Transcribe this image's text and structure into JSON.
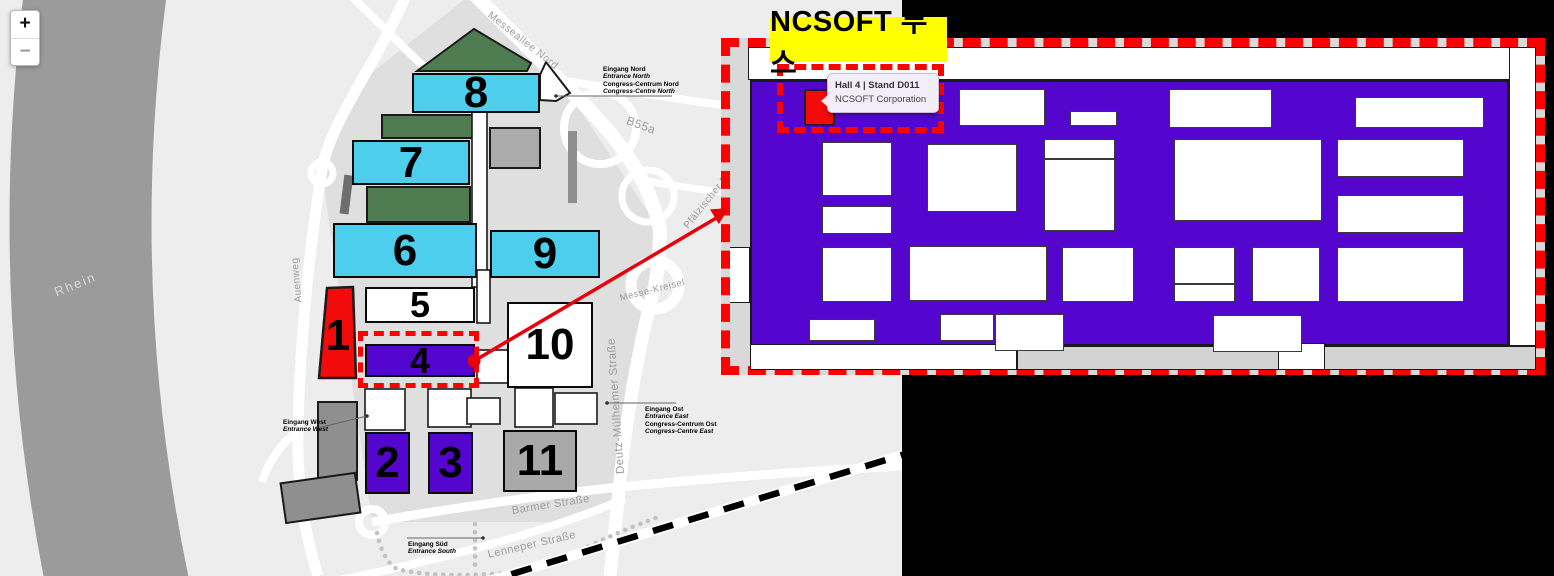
{
  "page": {
    "background": "#000000"
  },
  "colors": {
    "cyan": "#4CCEEC",
    "purple": "#5406CE",
    "red": "#F10B0B",
    "white": "#FFFFFF",
    "gray": "#A9A9A9",
    "green": "#4E7B50",
    "river": "#9B9B9B",
    "accent_red": "#FF0000",
    "callout_yellow": "#FFFF00"
  },
  "zoom_control": {
    "zoom_in_label": "+",
    "zoom_out_label": "−"
  },
  "map": {
    "river_label": "Rhein",
    "halls": [
      {
        "label": "8",
        "x": 412,
        "y": 73,
        "w": 128,
        "h": 40,
        "fill": "cyan",
        "fs": 44
      },
      {
        "label": "7",
        "x": 352,
        "y": 140,
        "w": 118,
        "h": 45,
        "fill": "cyan",
        "fs": 44
      },
      {
        "label": "6",
        "x": 333,
        "y": 223,
        "w": 144,
        "h": 55,
        "fill": "cyan",
        "fs": 44
      },
      {
        "label": "9",
        "x": 490,
        "y": 230,
        "w": 110,
        "h": 48,
        "fill": "cyan",
        "fs": 44
      },
      {
        "label": "5",
        "x": 365,
        "y": 287,
        "w": 110,
        "h": 36,
        "fill": "white",
        "fs": 36
      },
      {
        "label": "4",
        "x": 365,
        "y": 344,
        "w": 110,
        "h": 33,
        "fill": "purple",
        "fs": 36
      },
      {
        "label": "10",
        "x": 507,
        "y": 302,
        "w": 86,
        "h": 86,
        "fill": "white",
        "fs": 44
      },
      {
        "label": "2",
        "x": 365,
        "y": 432,
        "w": 45,
        "h": 62,
        "fill": "purple",
        "fs": 44
      },
      {
        "label": "3",
        "x": 428,
        "y": 432,
        "w": 45,
        "h": 62,
        "fill": "purple",
        "fs": 44
      },
      {
        "label": "11",
        "x": 503,
        "y": 430,
        "w": 74,
        "h": 62,
        "fill": "gray",
        "fs": 44
      }
    ],
    "hall1": {
      "label": "1",
      "fs": 44
    },
    "streets": [
      {
        "label": "Messeallee Nord",
        "x": 489,
        "y": 8,
        "rot": 38,
        "size": 10.5
      },
      {
        "label": "B55a",
        "x": 627,
        "y": 113,
        "rot": 20,
        "size": 12
      },
      {
        "label": "Messe-Kreisel",
        "x": 620,
        "y": 293,
        "rot": -14,
        "size": 9.5
      },
      {
        "label": "Deutz-Mülheimer Straße",
        "x": 621,
        "y": 468,
        "rot": -94,
        "size": 11.5
      },
      {
        "label": "Barmer Straße",
        "x": 512,
        "y": 505,
        "rot": -9,
        "size": 11
      },
      {
        "label": "Lenneper Straße",
        "x": 488,
        "y": 549,
        "rot": -13,
        "size": 11
      },
      {
        "label": "Auenweg",
        "x": 299,
        "y": 297,
        "rot": -95,
        "size": 10
      },
      {
        "label": "Pfälzischer Ring",
        "x": 686,
        "y": 222,
        "rot": -51,
        "size": 10
      },
      {
        "label": "Rhein",
        "x": 55,
        "y": 285,
        "rot": -22,
        "size": 13,
        "color": "#D9D9D9"
      }
    ],
    "entrances": [
      {
        "x": 603,
        "y": 66,
        "lines": [
          "Eingang Nord",
          "Entrance North",
          "Congress-Centrum Nord",
          "Congress-Centre North"
        ]
      },
      {
        "x": 645,
        "y": 406,
        "lines": [
          "Eingang Ost",
          "Entrance East",
          "Congress-Centrum Ost",
          "Congress-Centre East"
        ]
      },
      {
        "x": 283,
        "y": 419,
        "lines": [
          "Eingang West",
          "Entrance West"
        ]
      },
      {
        "x": 408,
        "y": 541,
        "lines": [
          "Eingang Süd",
          "Entrance South"
        ]
      }
    ]
  },
  "inset": {
    "callout_label": "NCSOFT 부스",
    "tooltip": {
      "title": "Hall 4 | Stand D011",
      "subtitle": "NCSOFT Corporation"
    },
    "floorplan": {
      "red_booth": [
        65,
        33,
        31,
        37
      ],
      "booths": [
        [
          220,
          33,
          86,
          37
        ],
        [
          331,
          55,
          47,
          15
        ],
        [
          83,
          86,
          70,
          54
        ],
        [
          83,
          150,
          70,
          28
        ],
        [
          83,
          191,
          70,
          55
        ],
        [
          188,
          88,
          90,
          68
        ],
        [
          170,
          190,
          138,
          55
        ],
        [
          305,
          83,
          71,
          20
        ],
        [
          305,
          103,
          71,
          72
        ],
        [
          323,
          191,
          72,
          55
        ],
        [
          430,
          33,
          103,
          39
        ],
        [
          616,
          41,
          129,
          31
        ],
        [
          435,
          83,
          148,
          82
        ],
        [
          598,
          83,
          127,
          38
        ],
        [
          598,
          139,
          127,
          38
        ],
        [
          435,
          191,
          61,
          37
        ],
        [
          435,
          228,
          61,
          18
        ],
        [
          513,
          191,
          68,
          55
        ],
        [
          598,
          191,
          127,
          55
        ],
        [
          474,
          259,
          89,
          37
        ],
        [
          70,
          263,
          66,
          22
        ],
        [
          201,
          258,
          54,
          27
        ],
        [
          256,
          258,
          69,
          37
        ]
      ]
    }
  }
}
